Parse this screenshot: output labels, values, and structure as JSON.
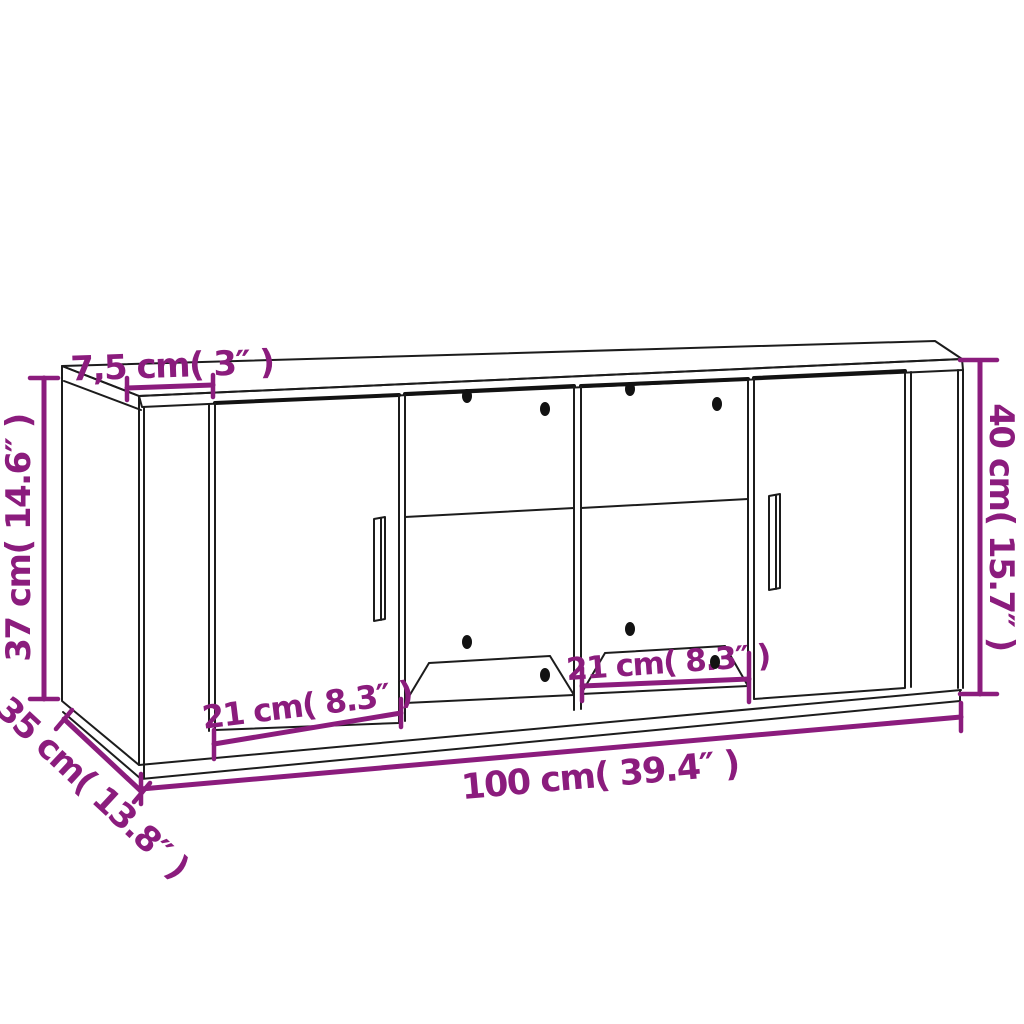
{
  "page": {
    "background_color": "#ffffff",
    "accent_color": "#8B1C7D",
    "line_color": "#1c1c1c"
  },
  "diagram": {
    "subject": "cabinet-dimension-drawing",
    "labels": {
      "top_thickness": "7,5 cm( 3″ )",
      "height_left": "37 cm( 14.6″ )",
      "depth": "35 cm( 13.8″ )",
      "width": "100 cm( 39.4″ )",
      "height_right": "40 cm( 15.7″ )",
      "door_width": "21 cm( 8.3″ )",
      "compartment_width": "21 cm( 8.3″ )"
    }
  }
}
